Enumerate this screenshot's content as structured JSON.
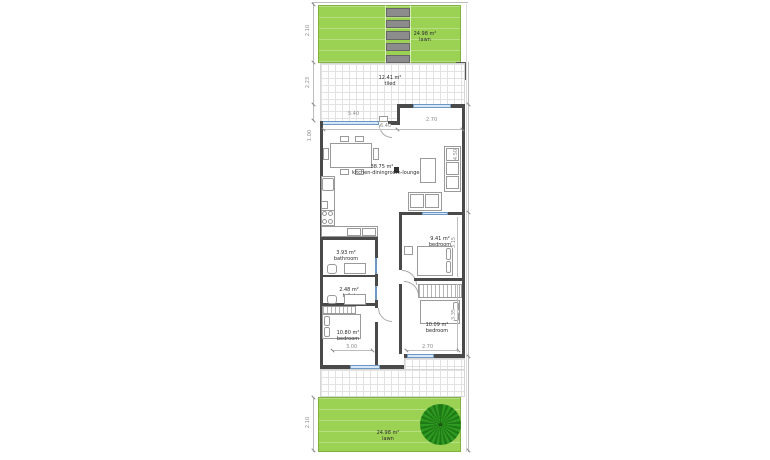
{
  "rooms": {
    "top_lawn": {
      "area": "24.98 m²",
      "name": "lawn"
    },
    "top_terrace": {
      "area": "12.41 m²",
      "name": "tiled"
    },
    "living": {
      "area": "38.75 m²",
      "name": "kitchen-diningroom-lounge"
    },
    "bedroom_mid_right": {
      "area": "9.41 m²",
      "name": "bedroom"
    },
    "bathroom": {
      "area": "3.93 m²",
      "name": "bathroom"
    },
    "toilet": {
      "area": "2.48 m²",
      "name": "toilet"
    },
    "bedroom_bottom_left": {
      "area": "10.80 m²",
      "name": "bedroom"
    },
    "bedroom_bottom_right": {
      "area": "10.09 m²",
      "name": "bedroom"
    },
    "bottom_lawn": {
      "area": "24.98 m²",
      "name": "lawn"
    }
  },
  "dimensions": {
    "top_lawn_depth": "2.10",
    "terrace_depth": "2.23",
    "front_window_width": "5.40",
    "front_left_width": "6.40",
    "front_right_width": "2.70",
    "living_left": "1.00",
    "living_right_depth": "4.50",
    "bedroom_mid_right_depth": "3.15",
    "bedroom_bottom_right_depth": "3.35",
    "bedroom_bottom_left_width": "3.00",
    "bedroom_bottom_right_width": "2.70",
    "bottom_lawn_depth": "2.10"
  },
  "colors": {
    "lawn": "#9CD254",
    "lawn_border": "#7FB23E",
    "tree_dark": "#1E7A14",
    "tree_light": "#2F9A22",
    "paver": "#8C8C8C",
    "paver_border": "#666666",
    "wall": "#4A4A4A",
    "window_fill": "#D6E7F7",
    "window_border": "#6F97C4",
    "furniture": "#9A9A9A",
    "grid_line": "#E2E2E2",
    "dim": "#8A8A8A",
    "label_text": "#2B2B2B"
  }
}
